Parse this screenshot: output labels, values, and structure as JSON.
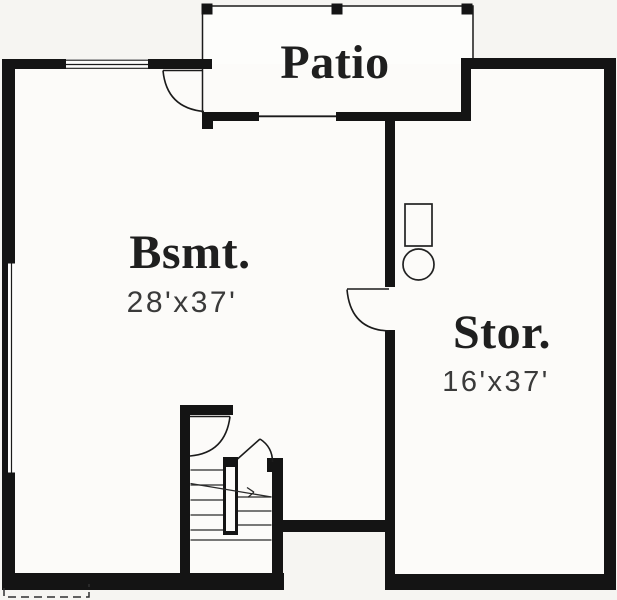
{
  "rooms": {
    "patio": {
      "label": "Patio"
    },
    "basement": {
      "label": "Bsmt.",
      "size": "28'x37'"
    },
    "storage": {
      "label": "Stor.",
      "size": "16'x37'"
    }
  },
  "colors": {
    "wall": "#141414",
    "line": "#1b1b1b",
    "background": "#f6f5f2",
    "room_fill": "#fcfbf9",
    "patio_fill": "#fdfdfb",
    "label_text": "#1f1f1f",
    "dimension_text": "#3a3a3a"
  }
}
